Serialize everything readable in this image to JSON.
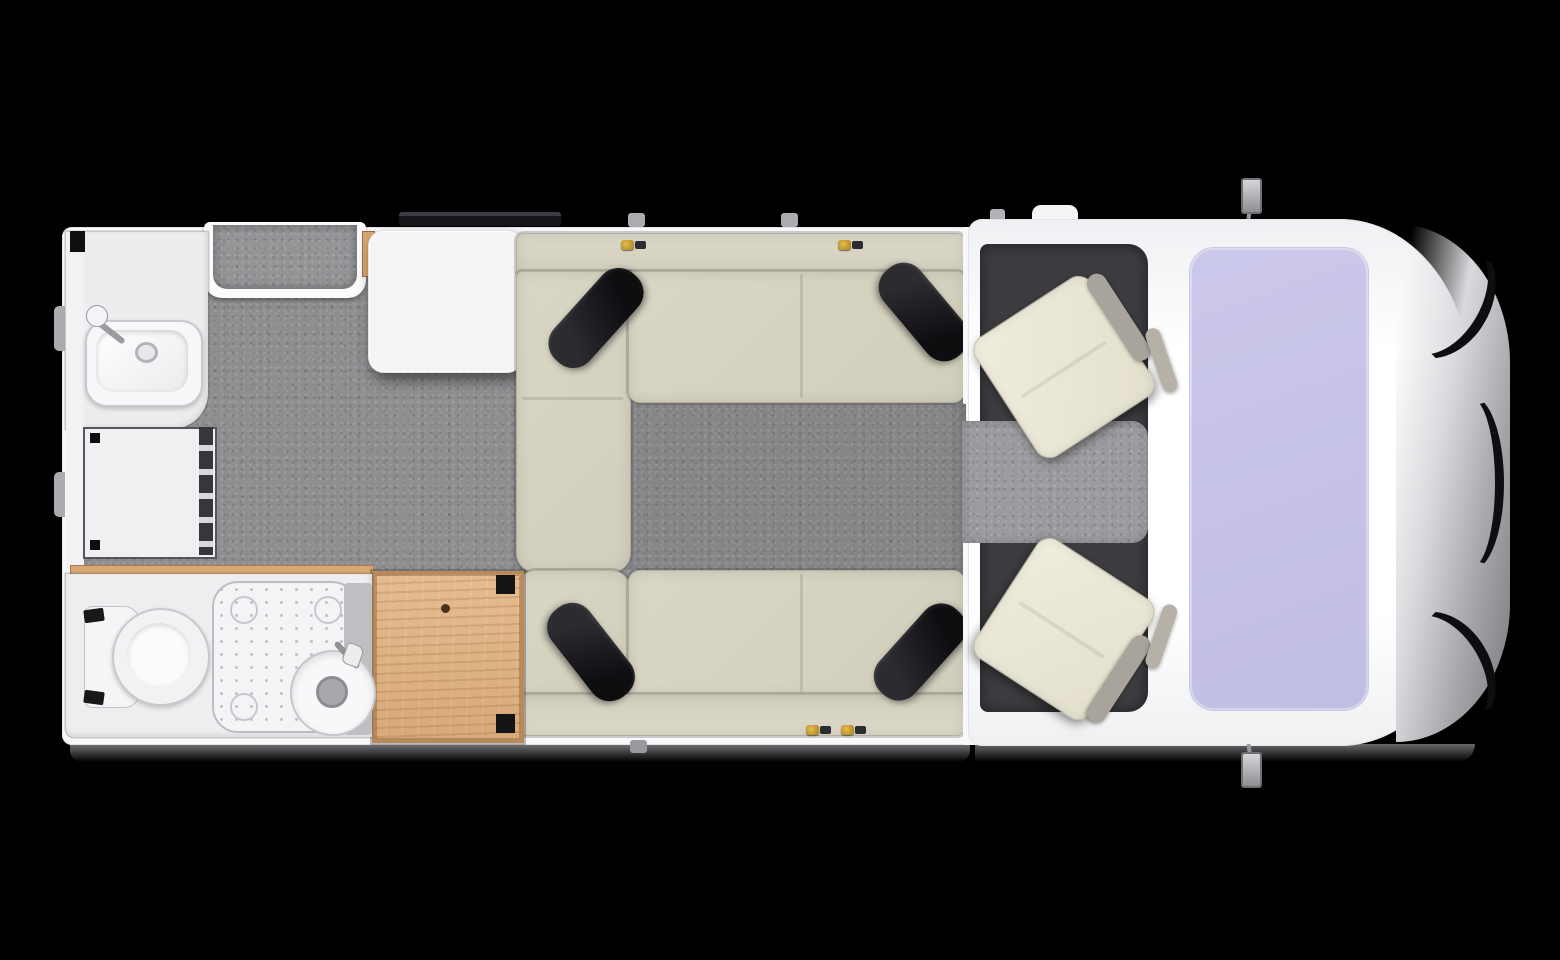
{
  "meta": {
    "title": "Motorhome floor plan — top view",
    "description": "Top-down floor plan of a semi-integrated motorhome on a black background. Rear (left): washroom with rectangular wash basin and faucet, storage cabinet below, and a bathroom with toilet, shower tray and round basin with vanity column; light wood wardrobe. Middle: grey textured floor, entry step recess and window on the top wall, white table, two facing beige L-bench sofas each with two dark decorative cushions and gold seat-belt anchors. Front (right): cab with dark floor, grey walkway, two cream swivel seats, white dashboard and hood, lavender windscreen, silver and black front bumper, and two side mirrors."
  },
  "palette": {
    "background": "#000000",
    "body_white": "#f8f8fa",
    "floor_gray": "#8e8e91",
    "entry_gray": "#949497",
    "cab_floor_dark": "#3d3d41",
    "walkway_gray": "#9b9b9f",
    "cushion_beige": "#d6d2c1",
    "cushion_back_beige": "#dad6c7",
    "pillow_black": "#1c1c20",
    "wood_light_oak": "#dfb488",
    "windshield_lavender": "#c6c3e7",
    "swivel_seat_cream": "#ece8d8",
    "seat_frame_gray": "#a8a49b",
    "bumper_silver": "#a5a5aa",
    "bumper_black": "#0e0e10",
    "seatbelt_gold": "#c9992b",
    "fixture_white": "#f4f4f6"
  },
  "vehicle": {
    "view": "top-down",
    "areas": [
      {
        "id": "rear-washroom",
        "fixtures": [
          "wash-basin",
          "faucet",
          "storage-cabinet"
        ]
      },
      {
        "id": "entry-step",
        "fixtures": [
          "door-recess"
        ]
      },
      {
        "id": "lounge",
        "fixtures": [
          "table",
          "top-bench-sofa",
          "bottom-bench-sofa",
          "4 dark cushions",
          "seat-belt anchors",
          "window"
        ]
      },
      {
        "id": "bathroom",
        "fixtures": [
          "toilet",
          "shower-tray",
          "round-basin",
          "vanity-column"
        ]
      },
      {
        "id": "wardrobe",
        "fixtures": [
          "wood-cabinet",
          "knob"
        ]
      },
      {
        "id": "cab",
        "fixtures": [
          "driver-swivel-seat",
          "passenger-swivel-seat",
          "windscreen",
          "dashboard",
          "side-mirror-top",
          "side-mirror-bottom",
          "front-bumper"
        ]
      }
    ],
    "counts": {
      "benches": 2,
      "dark_cushions": 4,
      "swivel_seats": 2,
      "side_mirrors": 2,
      "windows": 1
    }
  }
}
